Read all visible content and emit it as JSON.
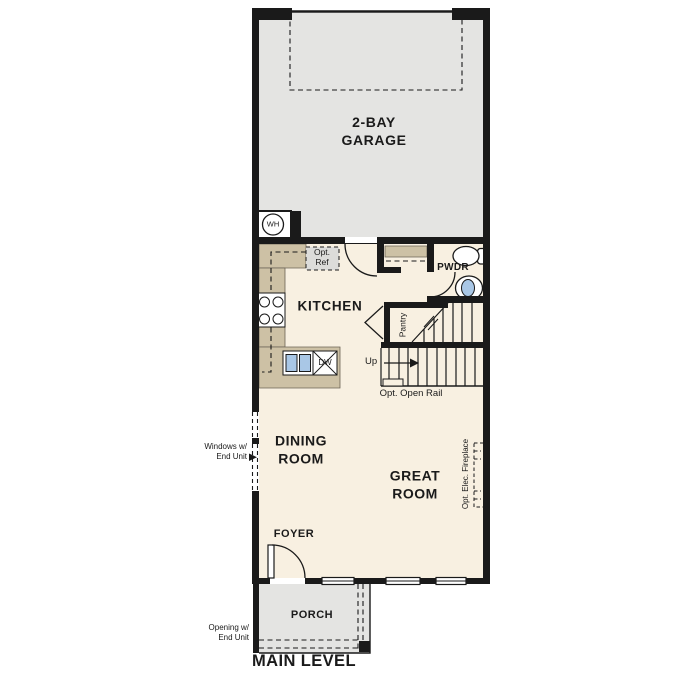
{
  "plan_title": "MAIN LEVEL",
  "colors": {
    "wall": "#1a1a1a",
    "garage-fill": "#e4e4e2",
    "floor-fill": "#f8f0e1",
    "porch-fill": "#e4e4e2",
    "counter-fill": "#cdc1a5",
    "counter-edge": "#6b6355",
    "fixture-blue": "#a9c7e6",
    "ref-box-fill": "#dcdcda",
    "text": "#1a1a1a"
  },
  "rooms": {
    "garage": {
      "label": "2-BAY\nGARAGE"
    },
    "kitchen": {
      "label": "KITCHEN"
    },
    "dining": {
      "label": "DINING\nROOM"
    },
    "great": {
      "label": "GREAT\nROOM"
    },
    "foyer": {
      "label": "FOYER"
    },
    "porch": {
      "label": "PORCH"
    },
    "powder": {
      "label": "PWDR"
    },
    "pantry": {
      "label": "Pantry"
    }
  },
  "annotations": {
    "water_heater": "WH",
    "opt_ref": "Opt.\nRef",
    "dishwasher": "DW",
    "up": "Up",
    "opt_open_rail": "Opt. Open Rail",
    "opt_elec_fireplace": "Opt. Elec. Fireplace",
    "windows_end_unit": "Windows w/\nEnd Unit",
    "opening_end_unit": "Opening w/\nEnd Unit"
  }
}
